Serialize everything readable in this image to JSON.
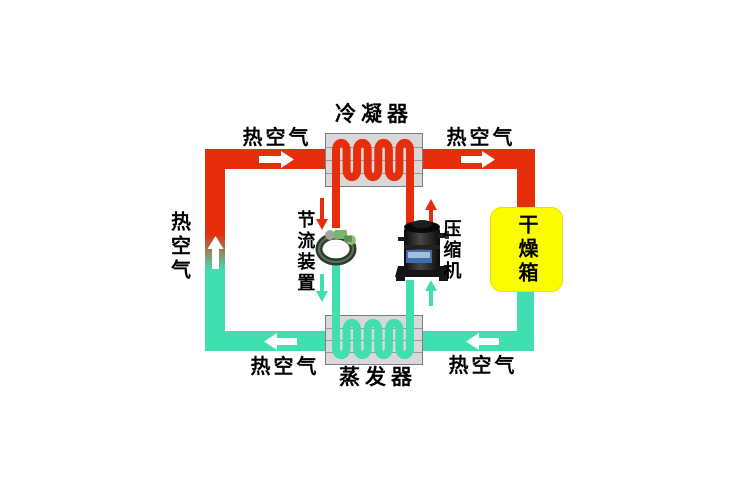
{
  "diagram": {
    "labels": {
      "condenser": "冷凝器",
      "evaporator": "蒸发器",
      "compressor": "压缩机",
      "throttle": "节流装置",
      "drying_box": "干燥箱",
      "hot_air": "热空气"
    },
    "colors": {
      "hot_pipe": "#e62e0d",
      "cold_pipe": "#3fdfb0",
      "drying_box_fill": "#fcfc00",
      "exchanger_fill": "#d8d8d8",
      "flow_arrow": "#ffffff"
    }
  }
}
